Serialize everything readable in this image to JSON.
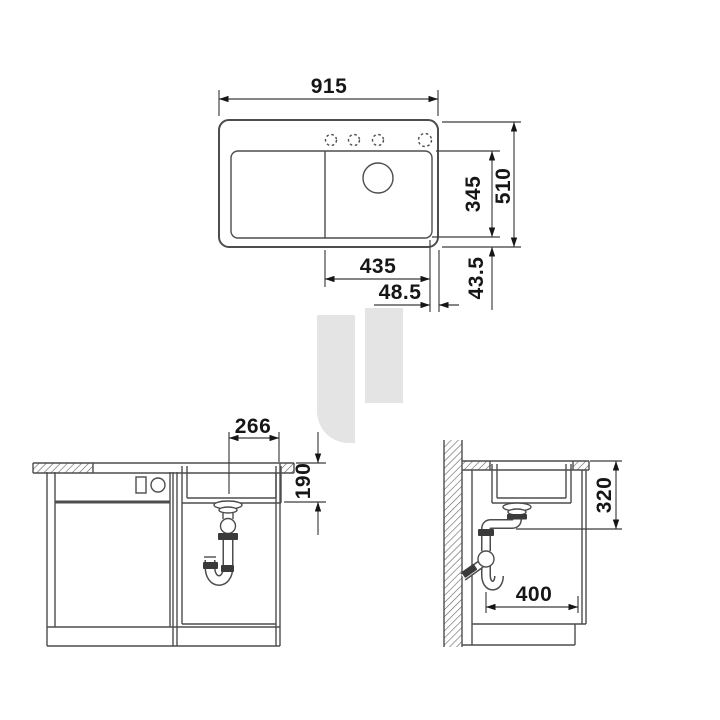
{
  "views": {
    "plan": {
      "dims": {
        "overall_width": "915",
        "overall_depth": "510",
        "bowl_depth": "345",
        "bowl_width": "435",
        "rim_offset_horizontal": "48.5",
        "rim_offset_vertical": "43.5"
      }
    },
    "front_section": {
      "dims": {
        "bowl_width": "266",
        "bowl_depth": "190"
      }
    },
    "side_section": {
      "dims": {
        "bowl_depth": "320",
        "bowl_base_length": "400"
      }
    }
  },
  "colors": {
    "line": "#4d4d4d",
    "dim": "#3c3c3c",
    "text": "#161616",
    "watermark": "#e4e4e4",
    "fitting": "#3a3a3a",
    "hatch": "#606060",
    "background": "#ffffff"
  }
}
